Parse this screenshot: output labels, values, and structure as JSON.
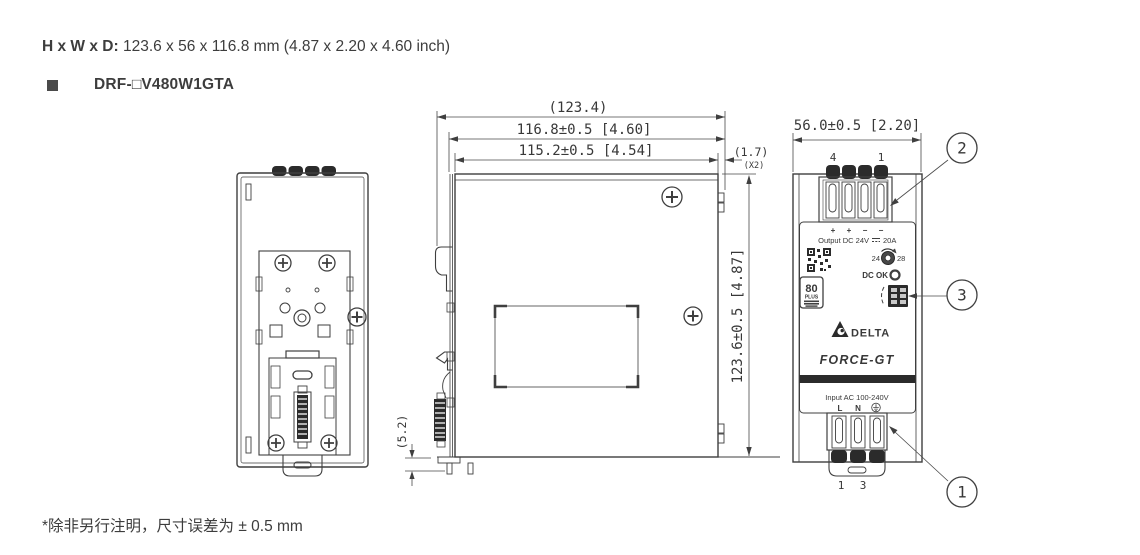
{
  "header": {
    "size_label": "H x W x D:",
    "size_value": " 123.6 x 56 x 116.8 mm (4.87 x 2.20 x 4.60 inch)",
    "model": "DRF-□V480W1GTA"
  },
  "footer": {
    "note": "*除非另行注明，尺寸误差为 ± 0.5 mm"
  },
  "side_view": {
    "dim_overall_depth": "(123.4)",
    "dim_depth_with_rail": "116.8±0.5 [4.60]",
    "dim_body_depth": "115.2±0.5 [4.54]",
    "dim_tab": "(1.7)",
    "dim_tab_qty": "(X2)",
    "dim_height": "123.6±0.5 [4.87]",
    "dim_clip_extension": "(5.2)"
  },
  "front_view": {
    "dim_width": "56.0±0.5 [2.20]",
    "output_terminal_left": "4",
    "output_terminal_right": "1",
    "polarity": [
      "+",
      "+",
      "−",
      "−"
    ],
    "output_label_prefix": "Output DC 24V",
    "output_label_suffix": "20A",
    "adjust_min": "24",
    "adjust_max": "28",
    "dc_ok_label": "DC OK",
    "badge_80": "80",
    "badge_plus": "PLUS",
    "brand": "DELTA",
    "product": "FORCE-GT",
    "input_label": "Input AC 100-240V",
    "input_line": "L",
    "input_neutral": "N",
    "input_terminal_left": "1",
    "input_terminal_right": "3"
  },
  "callouts": {
    "input": "1",
    "output": "2",
    "signal": "3"
  },
  "colors": {
    "line": "#3f3f3f",
    "dark_fill": "#2b2b2b",
    "text": "#3d3d3d"
  }
}
